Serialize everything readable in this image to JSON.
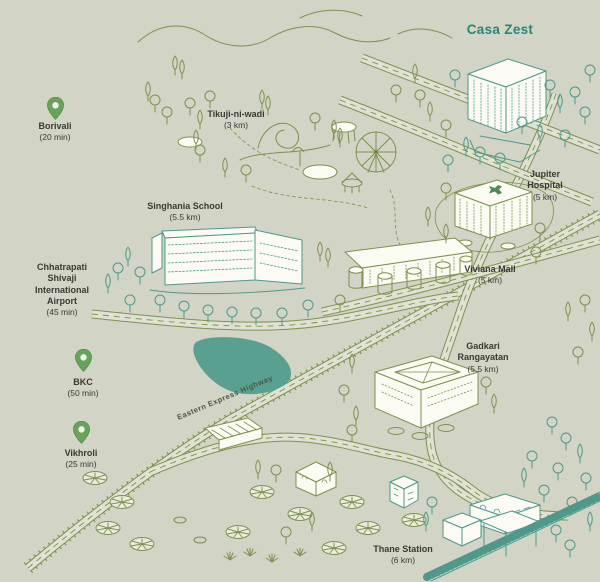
{
  "map": {
    "project_title": "Casa Zest",
    "road_label": "Eastern Express Highway",
    "landmarks": [
      {
        "name": "Tikuji-ni-wadi",
        "distance": "(3 km)"
      },
      {
        "name": "Jupiter Hospital",
        "distance": "(5 km)"
      },
      {
        "name": "Singhania School",
        "distance": "(5.5 km)"
      },
      {
        "name": "Viviana Mall",
        "distance": "(5 km)"
      },
      {
        "name": "Gadkari Rangayatan",
        "distance": "(5.5 km)"
      },
      {
        "name": "Thane Station",
        "distance": "(6 km)"
      }
    ],
    "transit_points": [
      {
        "name": "Borivali",
        "time": "(20 min)"
      },
      {
        "name": "Chhatrapati Shivaji International Airport",
        "time": "(45 min)"
      },
      {
        "name": "BKC",
        "time": "(50 min)"
      },
      {
        "name": "Vikhroli",
        "time": "(25 min)"
      }
    ],
    "colors": {
      "background": "#d2d4c5",
      "olive_line": "#7e914f",
      "teal_line": "#4e998b",
      "lake_fill": "#5aa090",
      "label_text": "#3a3a33",
      "pin_green": "#68a25c",
      "title_teal": "#2b8578"
    }
  }
}
